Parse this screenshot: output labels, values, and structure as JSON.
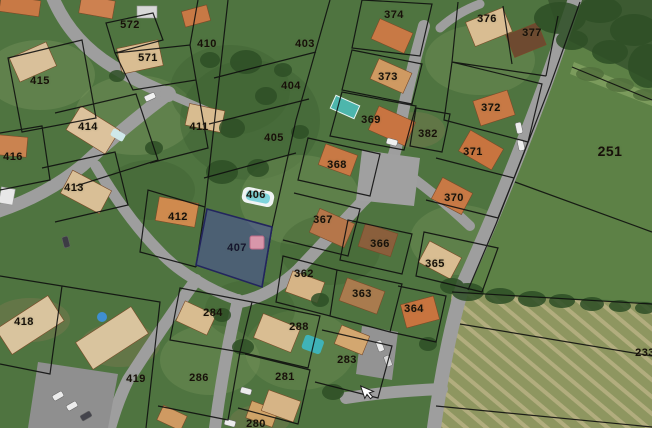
{
  "map": {
    "type": "cadastral-aerial-map",
    "selected_parcel": "407",
    "colors": {
      "highlight_fill": "#4a4fa3",
      "highlight_border": "#23255e",
      "marker_pink": "#e89cb0",
      "label_default": "#171009",
      "label_selected": "#14142e",
      "boundary": "#0d0d0d",
      "road": "#9e9e9e",
      "grass": "#4f7440",
      "field_bright": "#5d8146",
      "field_plowed": "#8e9660"
    },
    "cursor": {
      "x": 360,
      "y": 384,
      "icon": "mouse-pointer"
    },
    "marker": {
      "x": 250,
      "y": 236,
      "width": 14,
      "height": 13
    },
    "parcels": [
      {
        "id": "572",
        "x": 130,
        "y": 25
      },
      {
        "id": "571",
        "x": 148,
        "y": 58
      },
      {
        "id": "410",
        "x": 207,
        "y": 44
      },
      {
        "id": "415",
        "x": 40,
        "y": 81
      },
      {
        "id": "414",
        "x": 88,
        "y": 127
      },
      {
        "id": "411",
        "x": 199,
        "y": 127
      },
      {
        "id": "416",
        "x": 13,
        "y": 157
      },
      {
        "id": "413",
        "x": 74,
        "y": 188
      },
      {
        "id": "412",
        "x": 178,
        "y": 217
      },
      {
        "id": "403",
        "x": 305,
        "y": 44
      },
      {
        "id": "404",
        "x": 291,
        "y": 86
      },
      {
        "id": "405",
        "x": 274,
        "y": 138
      },
      {
        "id": "406",
        "x": 256,
        "y": 195
      },
      {
        "id": "407",
        "x": 237,
        "y": 248,
        "highlighted": true
      },
      {
        "id": "374",
        "x": 394,
        "y": 15
      },
      {
        "id": "373",
        "x": 388,
        "y": 77
      },
      {
        "id": "369",
        "x": 371,
        "y": 120
      },
      {
        "id": "368",
        "x": 337,
        "y": 165
      },
      {
        "id": "367",
        "x": 323,
        "y": 220
      },
      {
        "id": "366",
        "x": 380,
        "y": 244
      },
      {
        "id": "365",
        "x": 435,
        "y": 264
      },
      {
        "id": "362",
        "x": 304,
        "y": 274
      },
      {
        "id": "363",
        "x": 362,
        "y": 294
      },
      {
        "id": "364",
        "x": 414,
        "y": 309
      },
      {
        "id": "376",
        "x": 487,
        "y": 19
      },
      {
        "id": "377",
        "x": 532,
        "y": 33
      },
      {
        "id": "372",
        "x": 491,
        "y": 108
      },
      {
        "id": "371",
        "x": 473,
        "y": 152
      },
      {
        "id": "370",
        "x": 454,
        "y": 198
      },
      {
        "id": "382",
        "x": 428,
        "y": 134
      },
      {
        "id": "251",
        "x": 610,
        "y": 151,
        "size": 14
      },
      {
        "id": "418",
        "x": 24,
        "y": 322
      },
      {
        "id": "419",
        "x": 136,
        "y": 379
      },
      {
        "id": "284",
        "x": 213,
        "y": 313
      },
      {
        "id": "286",
        "x": 199,
        "y": 378
      },
      {
        "id": "288",
        "x": 299,
        "y": 327
      },
      {
        "id": "281",
        "x": 285,
        "y": 377
      },
      {
        "id": "283",
        "x": 347,
        "y": 360
      },
      {
        "id": "280",
        "x": 256,
        "y": 424
      },
      {
        "id": "233",
        "x": 645,
        "y": 353
      }
    ]
  }
}
